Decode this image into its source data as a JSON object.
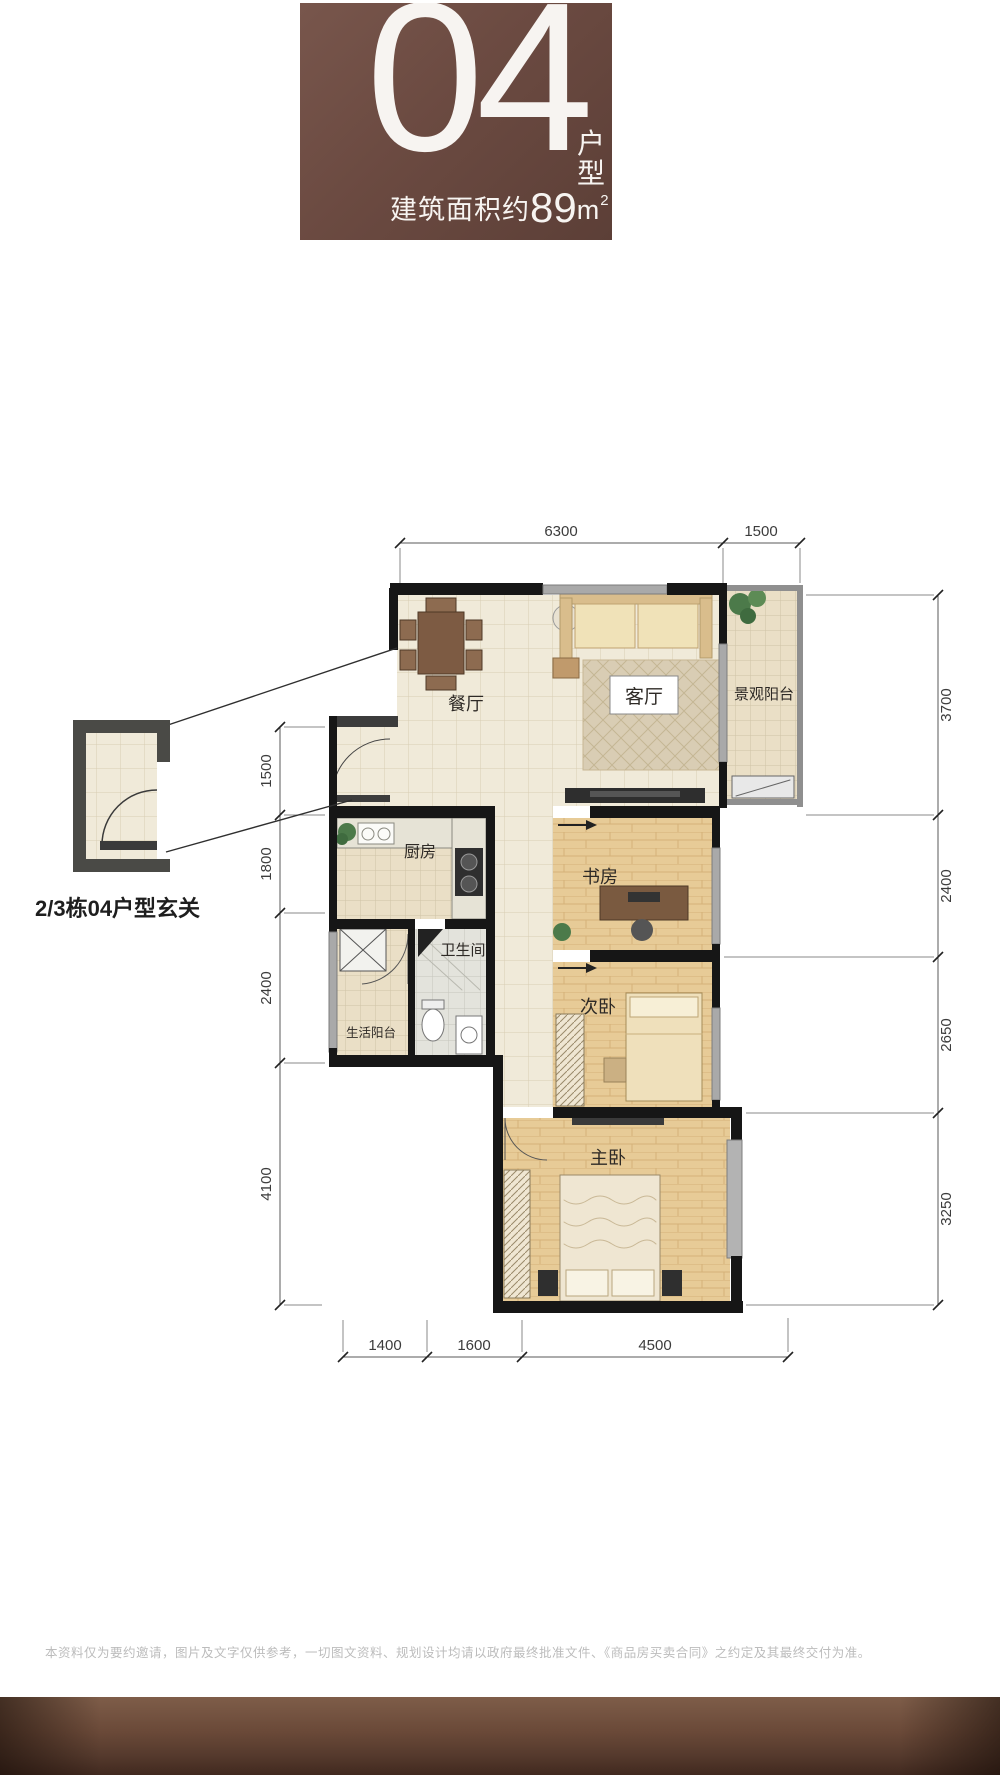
{
  "header": {
    "unit_number": "04",
    "unit_kind_top": "户",
    "unit_kind_bottom": "型",
    "area_prefix": "建筑面积约",
    "area_value": "89",
    "area_unit": "m",
    "area_sup": "2"
  },
  "plan": {
    "rooms": {
      "dining": "餐厅",
      "living": "客厅",
      "view_balcony": "景观阳台",
      "kitchen": "厨房",
      "bathroom": "卫生间",
      "service_balcony": "生活阳台",
      "study": "书房",
      "second_bedroom": "次卧",
      "master_bedroom": "主卧"
    },
    "dims": {
      "top": [
        "6300",
        "1500"
      ],
      "right": [
        "3700",
        "2400",
        "2650",
        "3250"
      ],
      "left": [
        "1500",
        "1800",
        "2400",
        "4100"
      ],
      "bottom": [
        "1400",
        "1600",
        "4500"
      ]
    }
  },
  "callout": {
    "label": "2/3栋04户型玄关"
  },
  "footer": {
    "disclaimer": "本资料仅为要约邀请，图片及文字仅供参考，一切图文资料、规划设计均请以政府最终批准文件、《商品房买卖合同》之约定及其最终交付为准。"
  },
  "colors": {
    "brand_brown": "#6b4a41",
    "wall": "#161616",
    "tile_floor": "#f0ead9",
    "wood_floor": "#e7cb97",
    "dim_line": "#5a5a5a"
  }
}
